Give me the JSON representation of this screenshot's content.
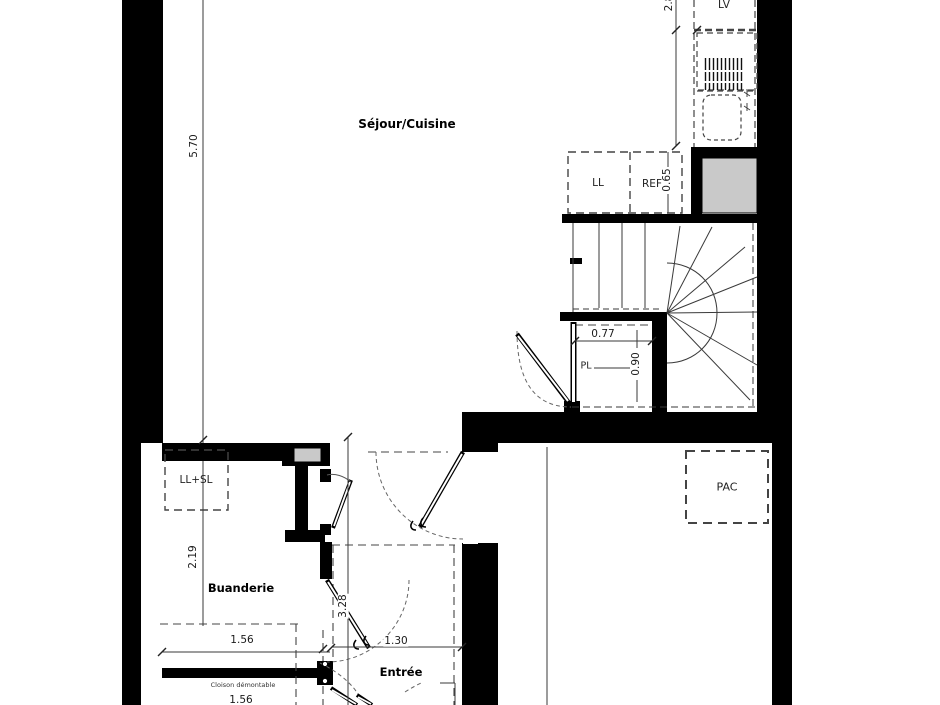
{
  "plan_title": "Floor plan — duplex lower level",
  "rooms": {
    "sejour": "Séjour/Cuisine",
    "buanderie": "Buanderie",
    "entree": "Entrée"
  },
  "labels": {
    "ll": "LL",
    "ref": "REF",
    "lv": "LV",
    "pl": "PL",
    "pac": "PAC",
    "llsl": "LL+SL",
    "cloison": "Cloison démontable"
  },
  "dimensions": {
    "sejour_height": "5.70",
    "kitchen_width": "2.8",
    "ref_width": "0.65",
    "pl_width": "0.77",
    "pl_depth": "0.90",
    "buanderie_height": "2.19",
    "buanderie_width": "1.56",
    "hall_length": "3.28",
    "entree_width": "1.30",
    "cloison_width": "1.56"
  },
  "colors": {
    "wall": "#000000",
    "duct_fill": "#c9c9c9",
    "line": "#3a3a3a"
  }
}
